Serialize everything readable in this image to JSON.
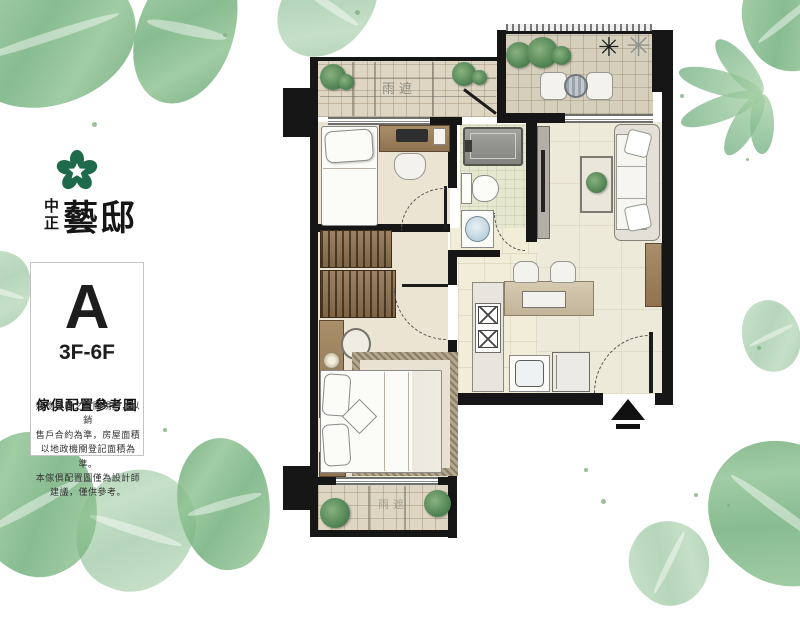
{
  "branding": {
    "logo_icon": "plum-blossom-icon",
    "logo_color": "#1f6a4a",
    "name_small_top": "中",
    "name_small_bottom": "正",
    "name_large": "藝邸"
  },
  "unit_card": {
    "unit_letter": "A",
    "floors": "3F-6F",
    "caption_title": "傢俱配置參考圖",
    "disclaimer_lines": [
      "建物樓層之空間規劃，以銷",
      "售戶合約為準，房屋面積",
      "以地政機關登記面積為準。",
      "本傢俱配置圖僅為設計師",
      "建議，僅供參考。"
    ]
  },
  "floor_plan": {
    "top_canopy_label": "雨遮",
    "bottom_canopy_label": "雨遮",
    "star_plant_icon_dark": "✳",
    "star_plant_icon_light": "✳",
    "entry_arrow_icon": "up-arrow"
  },
  "colors": {
    "wall": "#161616",
    "floor_cream": "#eeead9",
    "floor_bath": "#e6e7cf",
    "tile": "#ded6c2",
    "wood": "#9b8062",
    "leaf_green": "#6fae79",
    "logo_green": "#1f6a4a"
  }
}
